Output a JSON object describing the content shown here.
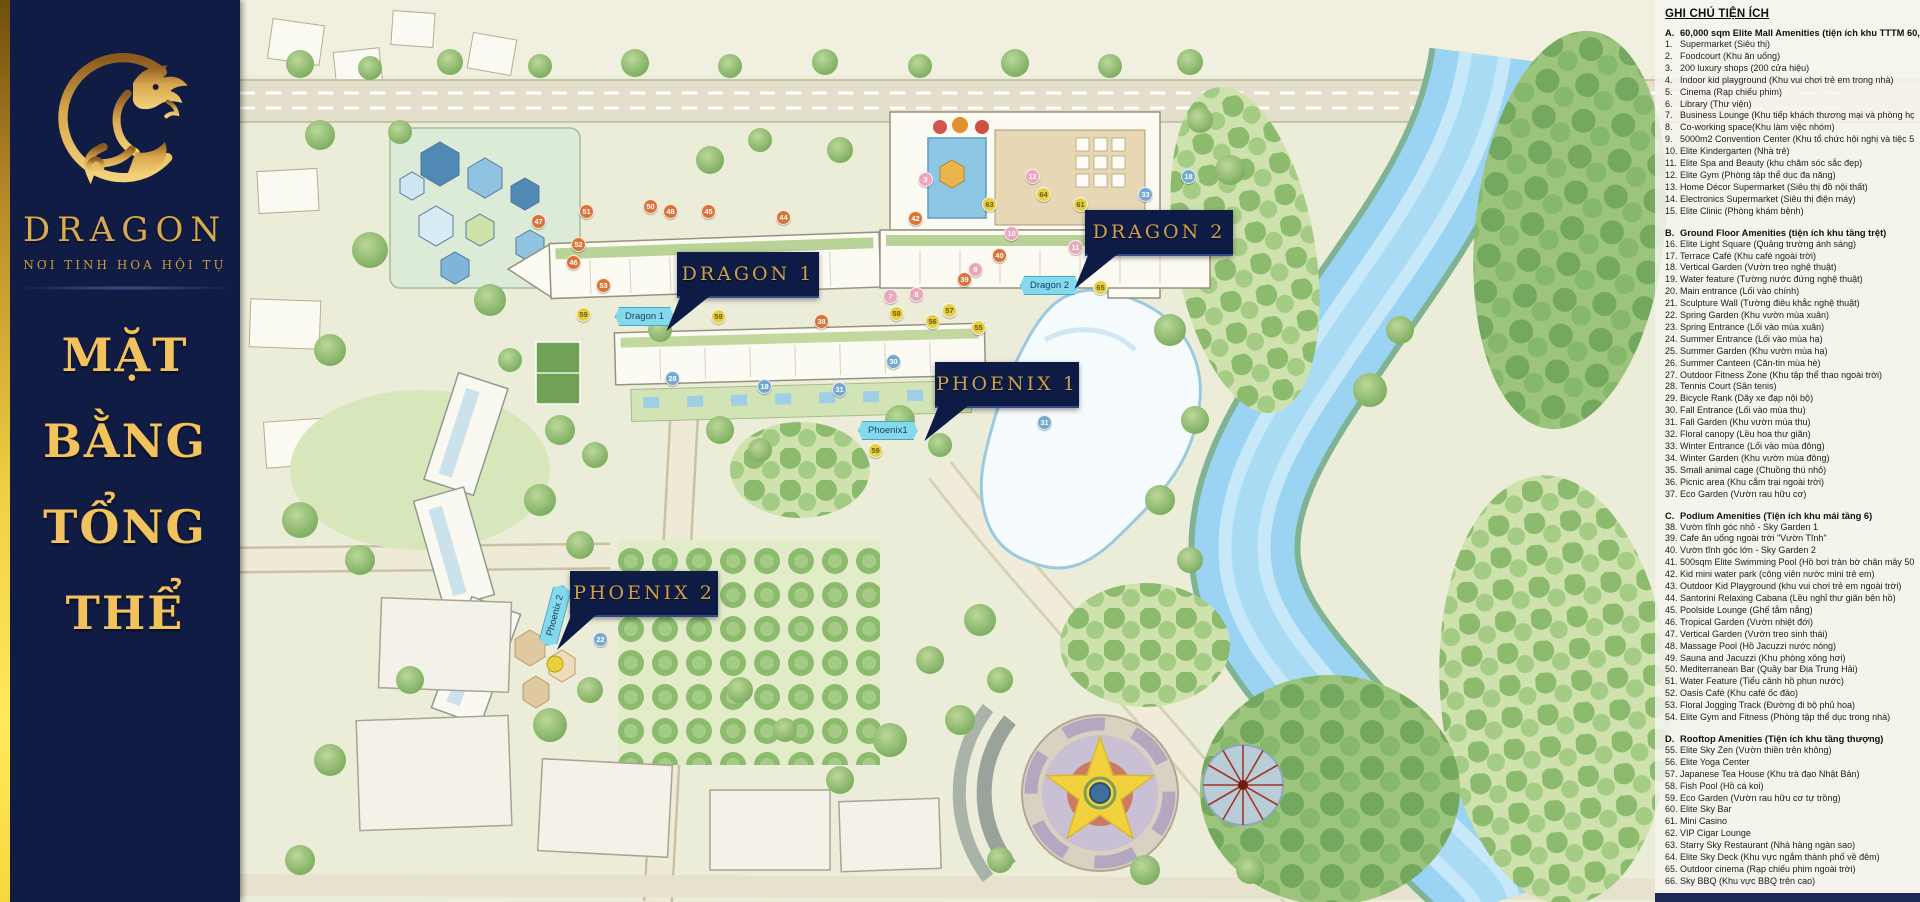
{
  "sidebar": {
    "brand": "DRAGON",
    "tagline": "NƠI TINH HOA HỘI TỤ",
    "title_lines": [
      "MẶT",
      "BẰNG",
      "TỔNG",
      "THỂ"
    ]
  },
  "map": {
    "banners": [
      {
        "id": "dragon-1",
        "label": "DRAGON 1"
      },
      {
        "id": "dragon-2",
        "label": "DRAGON 2"
      },
      {
        "id": "phoenix-1",
        "label": "PHOENIX 1"
      },
      {
        "id": "phoenix-2",
        "label": "PHOENIX 2"
      }
    ],
    "pills": [
      {
        "label": "Dragon 1"
      },
      {
        "label": "Dragon 2"
      },
      {
        "label": "Phoenix1"
      },
      {
        "label": "Phoenix 2"
      }
    ],
    "markers": [
      {
        "n": "47",
        "x": 297,
        "y": 220,
        "c": "o"
      },
      {
        "n": "51",
        "x": 345,
        "y": 210,
        "c": "o"
      },
      {
        "n": "50",
        "x": 409,
        "y": 205,
        "c": "o"
      },
      {
        "n": "48",
        "x": 429,
        "y": 210,
        "c": "o"
      },
      {
        "n": "45",
        "x": 467,
        "y": 210,
        "c": "o"
      },
      {
        "n": "52",
        "x": 337,
        "y": 243,
        "c": "o"
      },
      {
        "n": "46",
        "x": 332,
        "y": 261,
        "c": "o"
      },
      {
        "n": "44",
        "x": 542,
        "y": 216,
        "c": "o"
      },
      {
        "n": "53",
        "x": 362,
        "y": 284,
        "c": "o"
      },
      {
        "n": "59",
        "x": 342,
        "y": 313,
        "c": "y"
      },
      {
        "n": "59",
        "x": 477,
        "y": 315,
        "c": "y"
      },
      {
        "n": "38",
        "x": 580,
        "y": 320,
        "c": "o"
      },
      {
        "n": "3",
        "x": 684,
        "y": 178,
        "c": "p"
      },
      {
        "n": "12",
        "x": 791,
        "y": 175,
        "c": "p"
      },
      {
        "n": "64",
        "x": 802,
        "y": 193,
        "c": "y"
      },
      {
        "n": "63",
        "x": 748,
        "y": 203,
        "c": "y"
      },
      {
        "n": "61",
        "x": 839,
        "y": 203,
        "c": "y"
      },
      {
        "n": "42",
        "x": 674,
        "y": 217,
        "c": "o"
      },
      {
        "n": "33",
        "x": 904,
        "y": 193,
        "c": "b"
      },
      {
        "n": "10",
        "x": 770,
        "y": 232,
        "c": "p"
      },
      {
        "n": "11",
        "x": 834,
        "y": 246,
        "c": "p"
      },
      {
        "n": "40",
        "x": 758,
        "y": 254,
        "c": "o"
      },
      {
        "n": "9",
        "x": 734,
        "y": 268,
        "c": "p"
      },
      {
        "n": "39",
        "x": 723,
        "y": 278,
        "c": "o"
      },
      {
        "n": "18",
        "x": 947,
        "y": 175,
        "c": "b"
      },
      {
        "n": "65",
        "x": 859,
        "y": 286,
        "c": "y"
      },
      {
        "n": "7",
        "x": 649,
        "y": 295,
        "c": "p"
      },
      {
        "n": "8",
        "x": 675,
        "y": 293,
        "c": "p"
      },
      {
        "n": "58",
        "x": 655,
        "y": 312,
        "c": "y"
      },
      {
        "n": "57",
        "x": 708,
        "y": 309,
        "c": "y"
      },
      {
        "n": "56",
        "x": 691,
        "y": 320,
        "c": "y"
      },
      {
        "n": "55",
        "x": 737,
        "y": 326,
        "c": "y"
      },
      {
        "n": "30",
        "x": 652,
        "y": 360,
        "c": "b"
      },
      {
        "n": "28",
        "x": 431,
        "y": 377,
        "c": "b"
      },
      {
        "n": "18",
        "x": 523,
        "y": 385,
        "c": "b"
      },
      {
        "n": "31",
        "x": 598,
        "y": 388,
        "c": "b"
      },
      {
        "n": "59",
        "x": 634,
        "y": 449,
        "c": "y"
      },
      {
        "n": "31",
        "x": 803,
        "y": 421,
        "c": "b"
      },
      {
        "n": "22",
        "x": 359,
        "y": 638,
        "c": "b"
      }
    ]
  },
  "legend": {
    "title": "GHI CHÚ TIỆN ÍCH",
    "sections": [
      {
        "letter": "A.",
        "heading": "60,000 sqm Elite Mall Amenities (tiện ích khu TTTM 60,000m2)",
        "items": [
          {
            "n": "1.",
            "t": "Supermarket (Siêu thị)"
          },
          {
            "n": "2.",
            "t": "Foodcourt (Khu ăn uống)"
          },
          {
            "n": "3.",
            "t": "200 luxury shops (200 cửa hiệu)"
          },
          {
            "n": "4.",
            "t": "Indoor kid playground (Khu vui chơi trẻ em trong nhà)"
          },
          {
            "n": "5.",
            "t": "Cinema (Rạp chiếu phim)"
          },
          {
            "n": "6.",
            "t": "Library (Thư viện)"
          },
          {
            "n": "7.",
            "t": "Business Lounge (Khu tiếp khách thương mại và phòng họp)"
          },
          {
            "n": "8.",
            "t": "Co-working space(Khu làm việc nhóm)"
          },
          {
            "n": "9.",
            "t": "5000m2 Convention Center (Khu tổ chức hội nghị và tiệc 5000m2)"
          },
          {
            "n": "10.",
            "t": "Elite Kindergarten (Nhà trẻ)"
          },
          {
            "n": "11.",
            "t": "Elite Spa and Beauty (khu chăm sóc sắc đẹp)"
          },
          {
            "n": "12.",
            "t": "Elite Gym (Phòng tập thể dục đa năng)"
          },
          {
            "n": "13.",
            "t": "Home Décor Supermarket (Siêu thị đồ nội thất)"
          },
          {
            "n": "14.",
            "t": "Electronics Supermarket (Siêu thị điện máy)"
          },
          {
            "n": "15.",
            "t": "Elite Clinic (Phòng khám bệnh)"
          }
        ]
      },
      {
        "letter": "B.",
        "heading": "Ground Floor Amenities (tiện ích khu tầng trệt)",
        "items": [
          {
            "n": "16.",
            "t": "Elite Light Square (Quảng trường ánh sáng)"
          },
          {
            "n": "17.",
            "t": "Terrace Café (Khu café ngoài trời)"
          },
          {
            "n": "18.",
            "t": "Vertical Garden (Vườn treo nghệ thuật)"
          },
          {
            "n": "19.",
            "t": "Water feature (Tường nước đứng nghệ thuật)"
          },
          {
            "n": "20.",
            "t": "Main entrance (Lối vào chính)"
          },
          {
            "n": "21.",
            "t": "Sculpture Wall (Tường điêu khắc nghệ thuật)"
          },
          {
            "n": "22.",
            "t": "Spring Garden (Khu vườn mùa xuân)"
          },
          {
            "n": "23.",
            "t": "Spring Entrance (Lối vào mùa xuân)"
          },
          {
            "n": "24.",
            "t": "Summer Entrance (Lối vào mùa hạ)"
          },
          {
            "n": "25.",
            "t": "Summer Garden (Khu vườn mùa hạ)"
          },
          {
            "n": "26.",
            "t": "Summer Canteen (Căn-tin mùa hè)"
          },
          {
            "n": "27.",
            "t": "Outdoor Fitness Zone (Khu tập thể thao ngoài trời)"
          },
          {
            "n": "28.",
            "t": "Tennis Court (Sân tenis)"
          },
          {
            "n": "29.",
            "t": "Bicycle Rank (Dãy xe đạp nội bộ)"
          },
          {
            "n": "30.",
            "t": "Fall Entrance (Lối vào mùa thu)"
          },
          {
            "n": "31.",
            "t": "Fall Garden (Khu vườn mùa thu)"
          },
          {
            "n": "32.",
            "t": "Floral canopy (Lều hoa thư giãn)"
          },
          {
            "n": "33.",
            "t": "Winter Entrance (Lối vào mùa đông)"
          },
          {
            "n": "34.",
            "t": "Winter Garden (Khu vườn mùa đông)"
          },
          {
            "n": "35.",
            "t": "Small animal cage (Chuồng thú nhỏ)"
          },
          {
            "n": "36.",
            "t": "Picnic area (Khu cắm trại ngoài trời)"
          },
          {
            "n": "37.",
            "t": "Eco Garden (Vườn rau hữu cơ)"
          }
        ]
      },
      {
        "letter": "C.",
        "heading": "Podium Amenities (Tiện ích khu mái tầng 6)",
        "items": [
          {
            "n": "38.",
            "t": "Vườn tĩnh góc nhỏ - Sky Garden 1"
          },
          {
            "n": "39.",
            "t": "Cafe ăn uống ngoài trời \"Vườn Tĩnh\""
          },
          {
            "n": "40.",
            "t": "Vườn tĩnh góc lớn - Sky Garden 2"
          },
          {
            "n": "41.",
            "t": "500sqm Elite Swimming Pool (Hồ bơi tràn bờ chân mây 500m2)"
          },
          {
            "n": "42.",
            "t": "Kid mini water park (công viên nước mini trẻ em)"
          },
          {
            "n": "43.",
            "t": "Outdoor Kid Playground (khu vui chơi trẻ em ngoài trời)"
          },
          {
            "n": "44.",
            "t": "Santorini Relaxing Cabana (Lều nghỉ thư giãn bên hồ)"
          },
          {
            "n": "45.",
            "t": "Poolside Lounge (Ghế tắm nắng)"
          },
          {
            "n": "46.",
            "t": "Tropical Garden (Vườn nhiệt đới)"
          },
          {
            "n": "47.",
            "t": "Vertical Garden (Vườn treo sinh thái)"
          },
          {
            "n": "48.",
            "t": "Massage Pool (Hồ Jacuzzi nước nóng)"
          },
          {
            "n": "49.",
            "t": "Sauna and Jacuzzi (Khu phòng xông hơi)"
          },
          {
            "n": "50.",
            "t": "Mediterranean Bar (Quầy bar Địa Trung Hải)"
          },
          {
            "n": "51.",
            "t": "Water Feature (Tiểu cảnh hồ phun nước)"
          },
          {
            "n": "52.",
            "t": "Oasis Café (Khu café ốc đảo)"
          },
          {
            "n": "53.",
            "t": "Floral Jogging Track (Đường đi bộ phủ hoa)"
          },
          {
            "n": "54.",
            "t": "Elite Gym and Fitness (Phòng tập thể dục trong nhà)"
          }
        ]
      },
      {
        "letter": "D.",
        "heading": "Rooftop Amenities (Tiện ích khu tầng thượng)",
        "items": [
          {
            "n": "55.",
            "t": "Elite Sky Zen (Vườn thiền trên không)"
          },
          {
            "n": "56.",
            "t": "Elite Yoga Center"
          },
          {
            "n": "57.",
            "t": "Japanese Tea House (Khu trà đạo Nhật Bản)"
          },
          {
            "n": "58.",
            "t": "Fish Pool (Hồ cá koi)"
          },
          {
            "n": "59.",
            "t": "Eco Garden (Vườn rau hữu cơ tự trồng)"
          },
          {
            "n": "60.",
            "t": "Elite Sky Bar"
          },
          {
            "n": "61.",
            "t": "Mini Casino"
          },
          {
            "n": "62.",
            "t": "VIP Cigar Lounge"
          },
          {
            "n": "63.",
            "t": "Starry Sky Restaurant (Nhà hàng ngàn sao)"
          },
          {
            "n": "64.",
            "t": "Elite Sky Deck (Khu vực ngắm thành phố về đêm)"
          },
          {
            "n": "65.",
            "t": "Outdoor cinema (Rạp chiếu phim ngoài trời)"
          },
          {
            "n": "66.",
            "t": "Sky BBQ (Khu vực BBQ trên cao)"
          }
        ]
      }
    ]
  },
  "colors": {
    "navy": "#111c44",
    "gold": "#d9a94e",
    "gold_bright": "#f2c25c",
    "pill_cyan": "#85d9ec",
    "river_blue": "#9ad4f2",
    "marker_orange": "#d97436",
    "marker_yellow": "#e5cf44",
    "marker_pink": "#eba6ba",
    "marker_blue": "#74a9cf"
  }
}
